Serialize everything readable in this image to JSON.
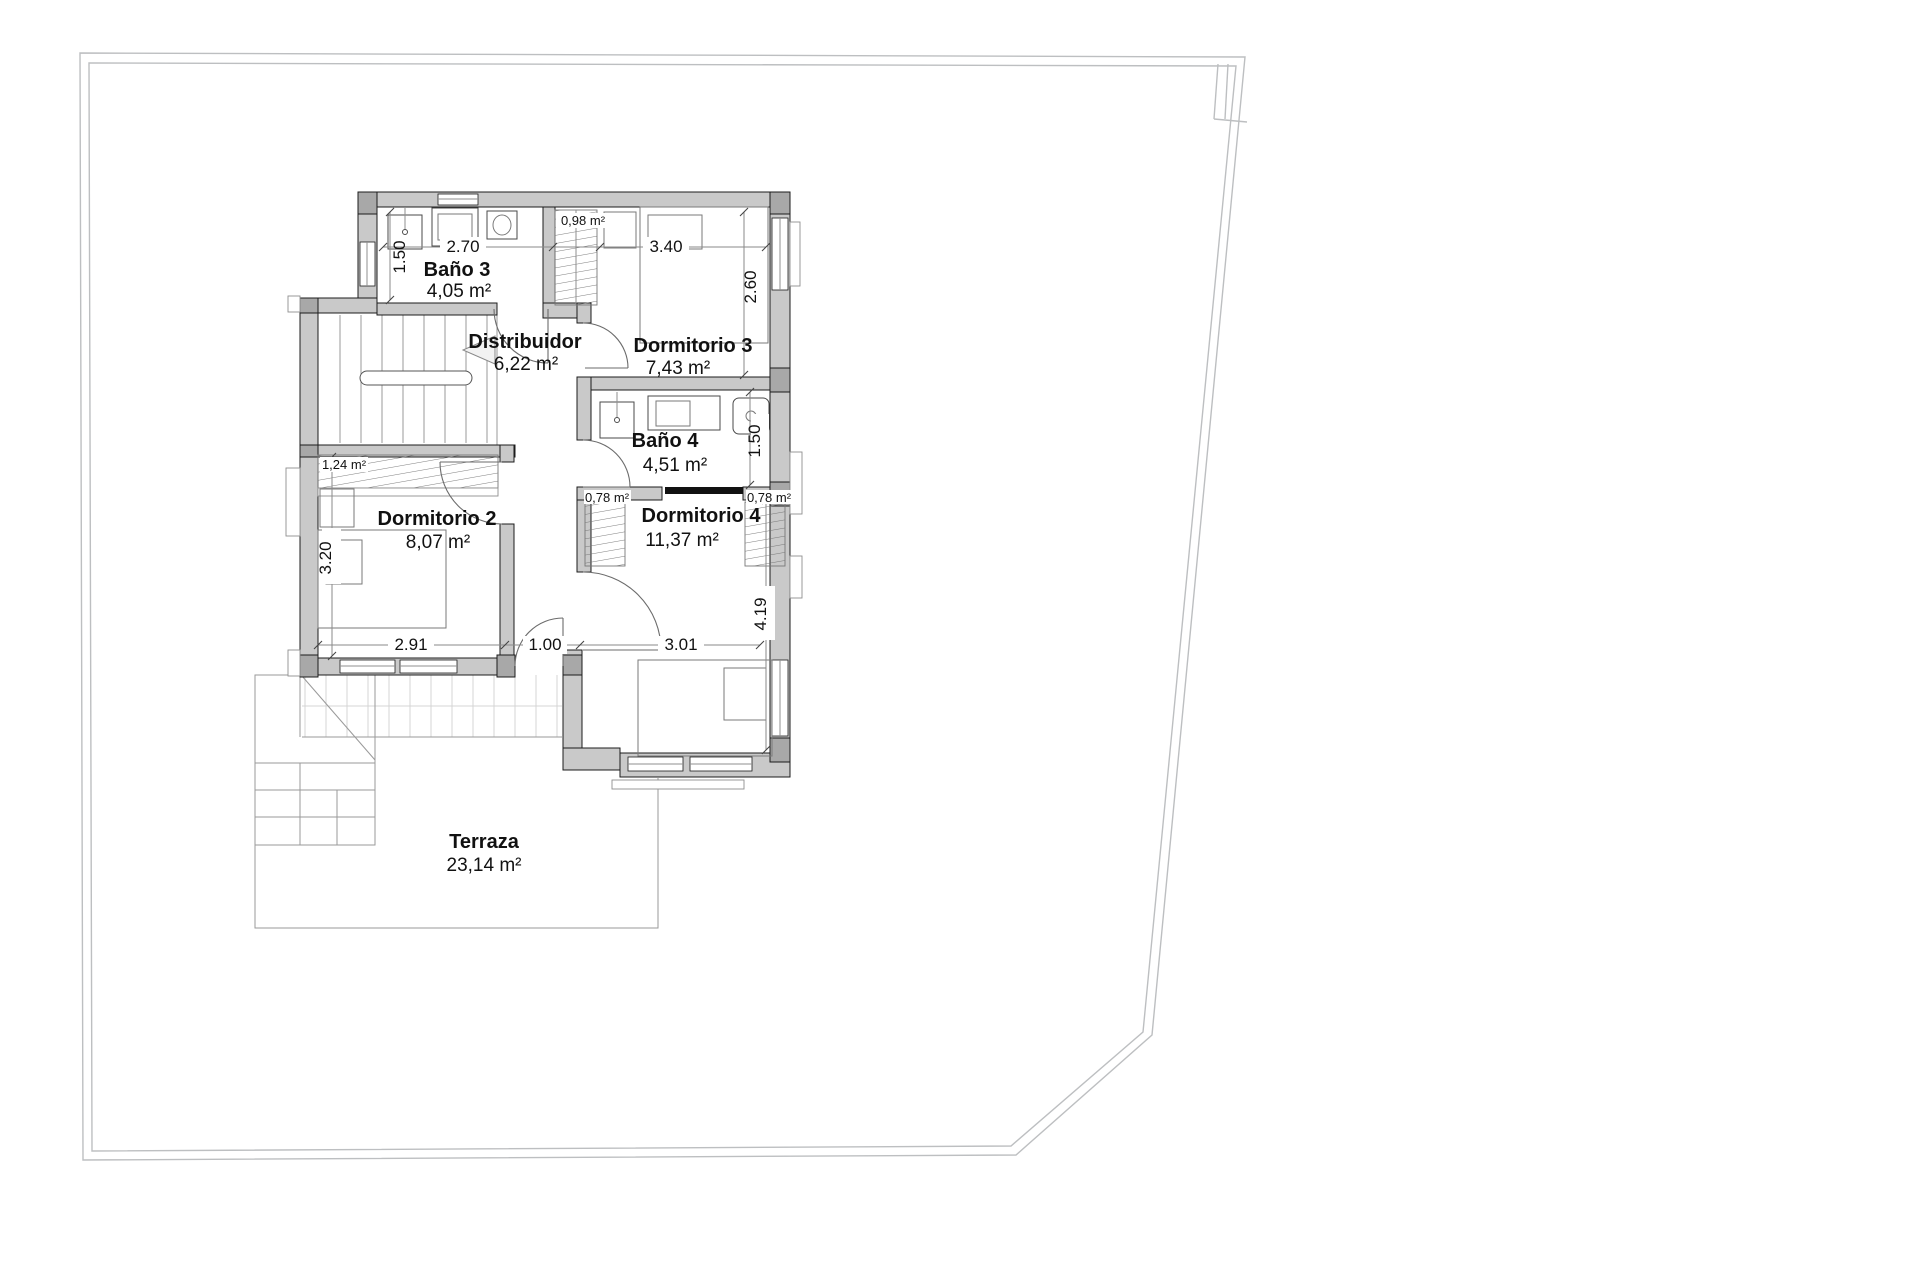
{
  "document": {
    "type": "architectural-floor-plan"
  },
  "palette": {
    "wall_fill": "#c9c9c9",
    "pillar_fill": "#a8a8a8",
    "wall_stroke": "#1c1c1c",
    "thin_line": "#8f8f8f",
    "tile_line": "#d4d4d4",
    "boundary_line": "#bdbfc1",
    "hatch_line": "#6f6f6f",
    "slider_door": "#111111",
    "text": "#111111"
  },
  "rooms": {
    "bano3": {
      "name": "Baño 3",
      "area": "4,05 m²"
    },
    "distribuidor": {
      "name": "Distribuidor",
      "area": "6,22 m²"
    },
    "dormitorio3": {
      "name": "Dormitorio 3",
      "area": "7,43 m²"
    },
    "bano4": {
      "name": "Baño 4",
      "area": "4,51 m²"
    },
    "dormitorio2": {
      "name": "Dormitorio 2",
      "area": "8,07 m²"
    },
    "dormitorio4": {
      "name": "Dormitorio 4",
      "area": "11,37 m²"
    },
    "terraza": {
      "name": "Terraza",
      "area": "23,14 m²"
    }
  },
  "closets": {
    "dorm3_wardrobe": {
      "area": "0,98 m²"
    },
    "dorm2_wardrobe": {
      "area": "1,24 m²"
    },
    "dorm4_wardrobe_left": {
      "area": "0,78 m²"
    },
    "dorm4_wardrobe_right": {
      "area": "0,78 m²"
    }
  },
  "dimensions": {
    "bano3_width": "2.70",
    "bano3_depth": "1.50",
    "dorm3_width": "3.40",
    "dorm3_depth": "2.60",
    "bano4_depth": "1.50",
    "dorm2_depth": "3.20",
    "dorm2_width": "2.91",
    "hallway_width": "1.00",
    "dorm4_width": "3.01",
    "dorm4_depth": "4.19"
  }
}
